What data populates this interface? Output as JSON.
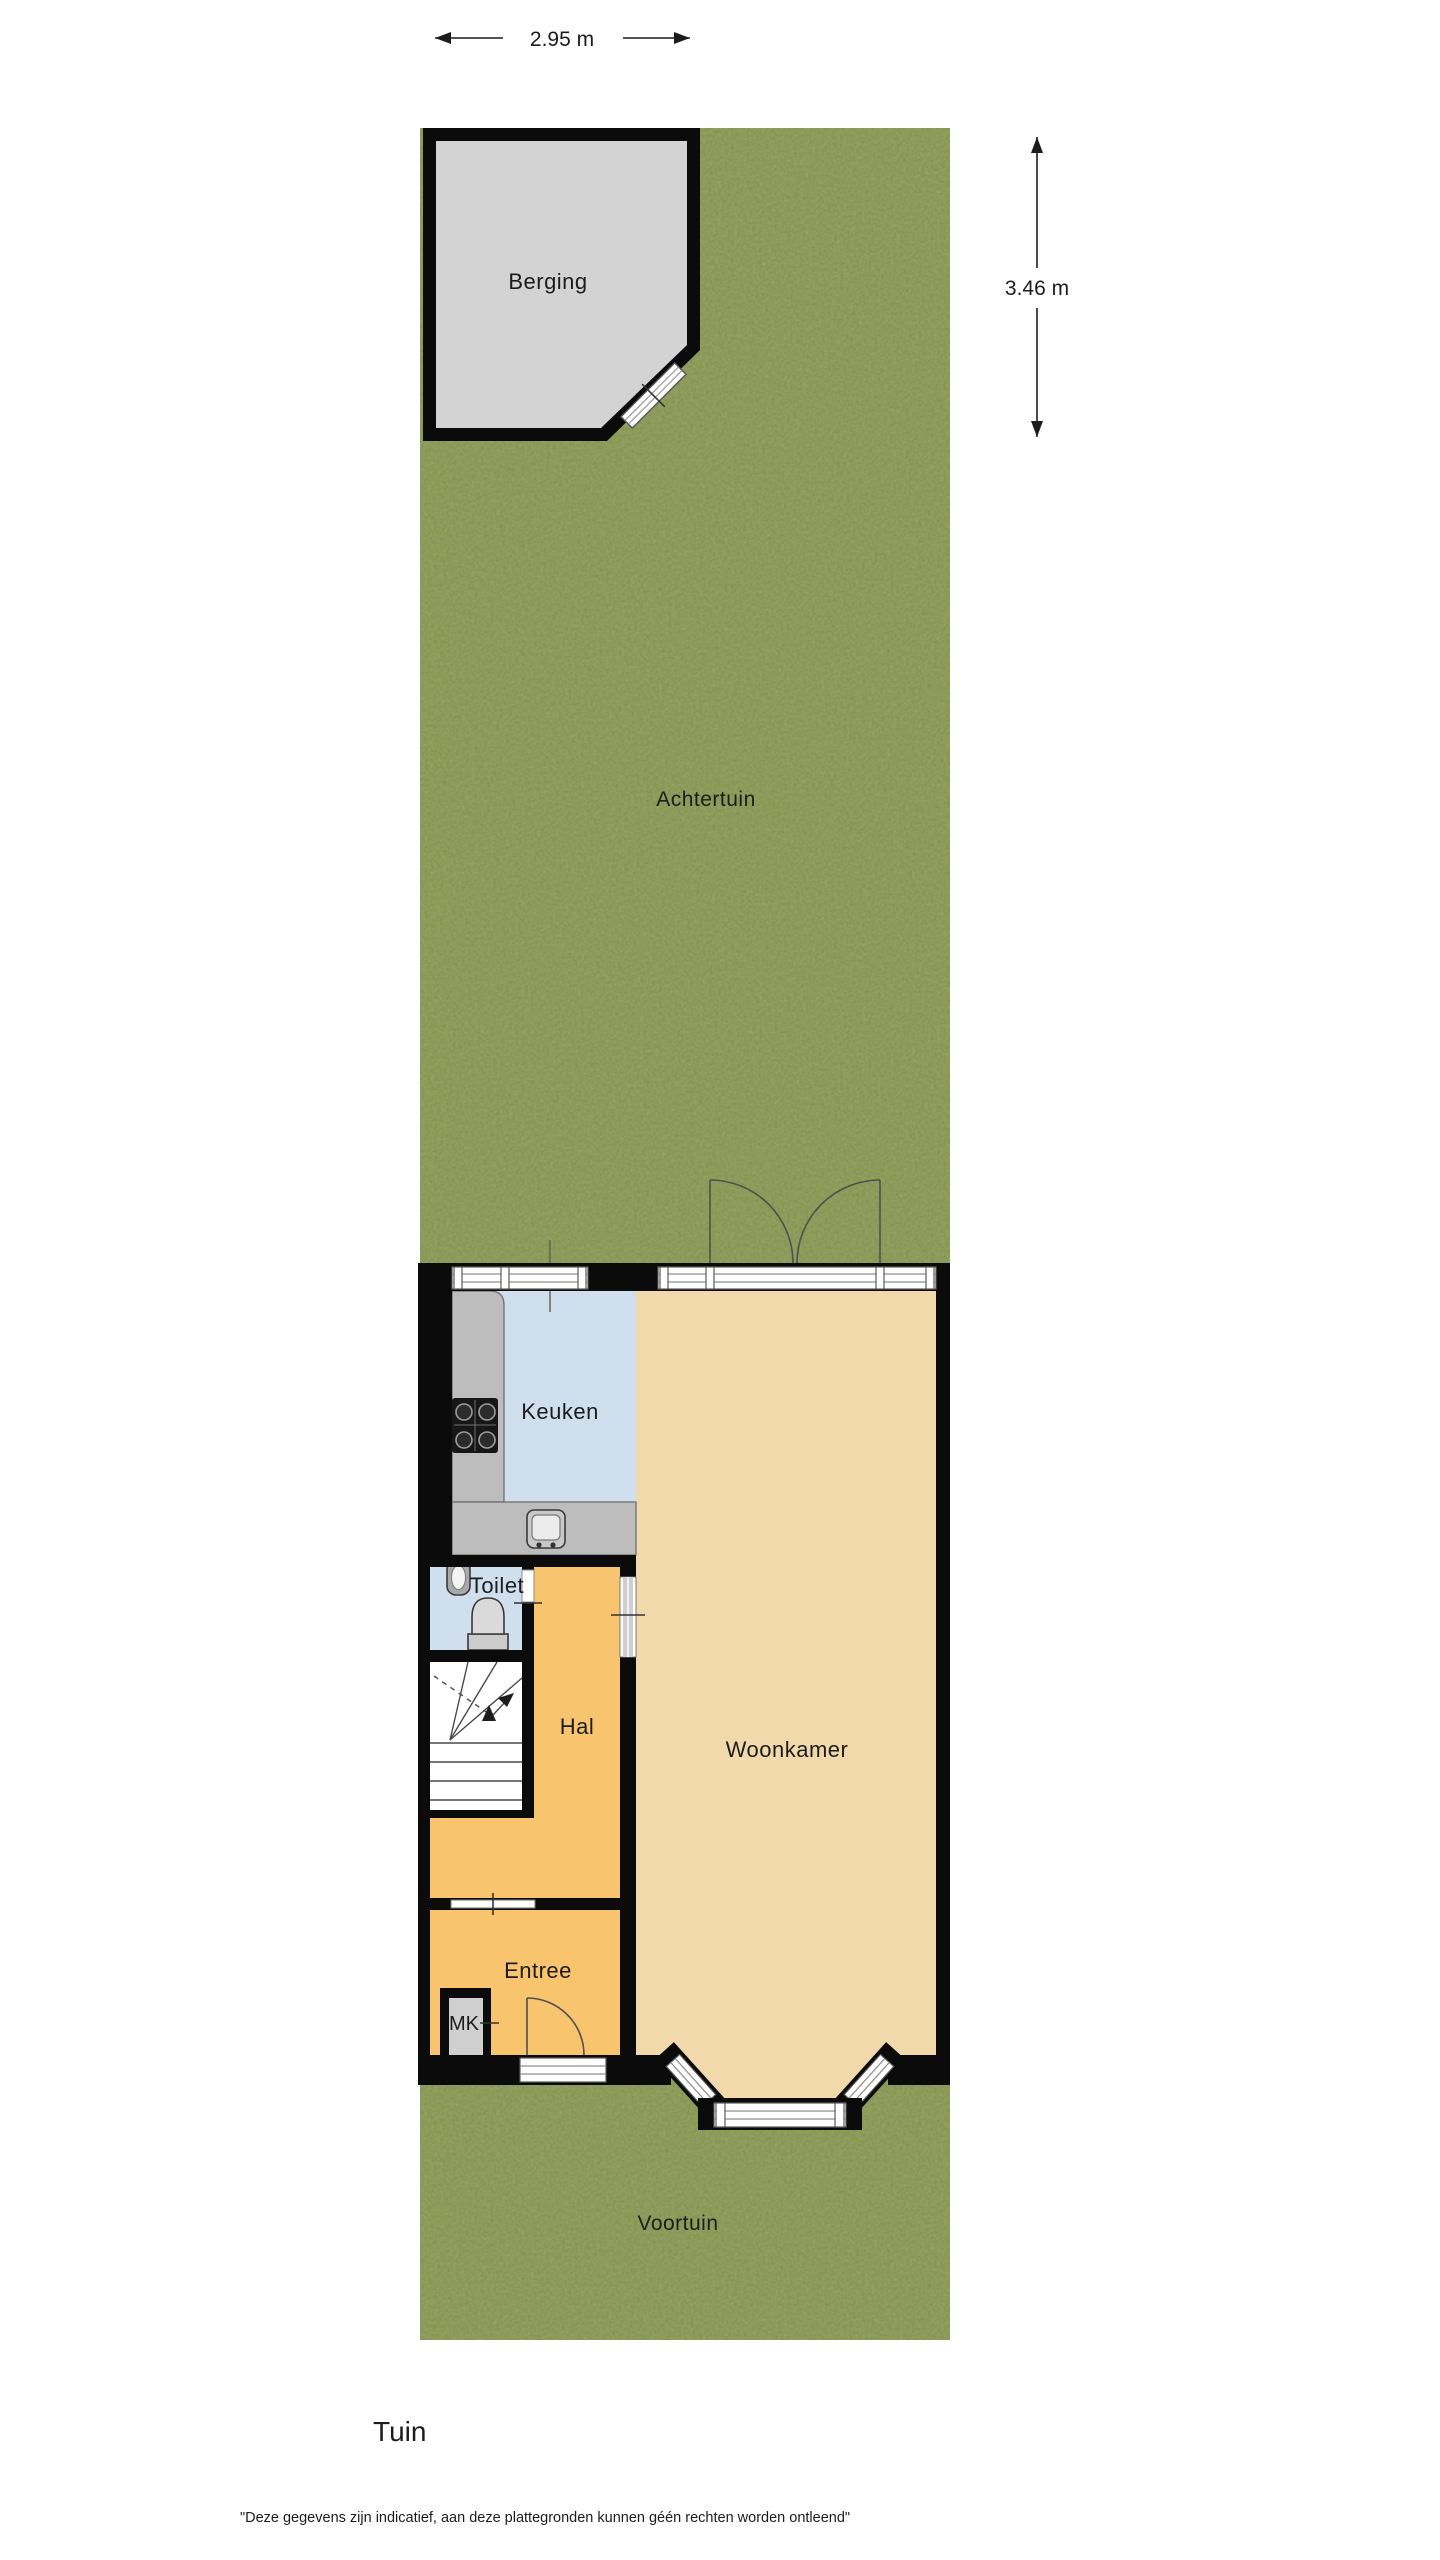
{
  "title": "Tuin",
  "disclaimer": "\"Deze gegevens zijn indicatief, aan deze plattegronden kunnen géén rechten worden ontleend\"",
  "dimensions": {
    "shed_width": "2.95 m",
    "shed_height": "3.46 m"
  },
  "areas": {
    "garden_back": "Achtertuin",
    "garden_front": "Voortuin",
    "shed": "Berging",
    "kitchen": "Keuken",
    "living_room": "Woonkamer",
    "toilet": "Toilet",
    "hall": "Hal",
    "entry": "Entree",
    "meter_closet": "MK"
  },
  "colors": {
    "background": "#ffffff",
    "grass": "#7e8d49",
    "shed_floor": "#d3d3d3",
    "kitchen_floor": "#cfdfee",
    "living_floor": "#f1d9ab",
    "hall_floor": "#f8c46e",
    "counter": "#bdbdbd",
    "wall": "#0b0b0b"
  }
}
